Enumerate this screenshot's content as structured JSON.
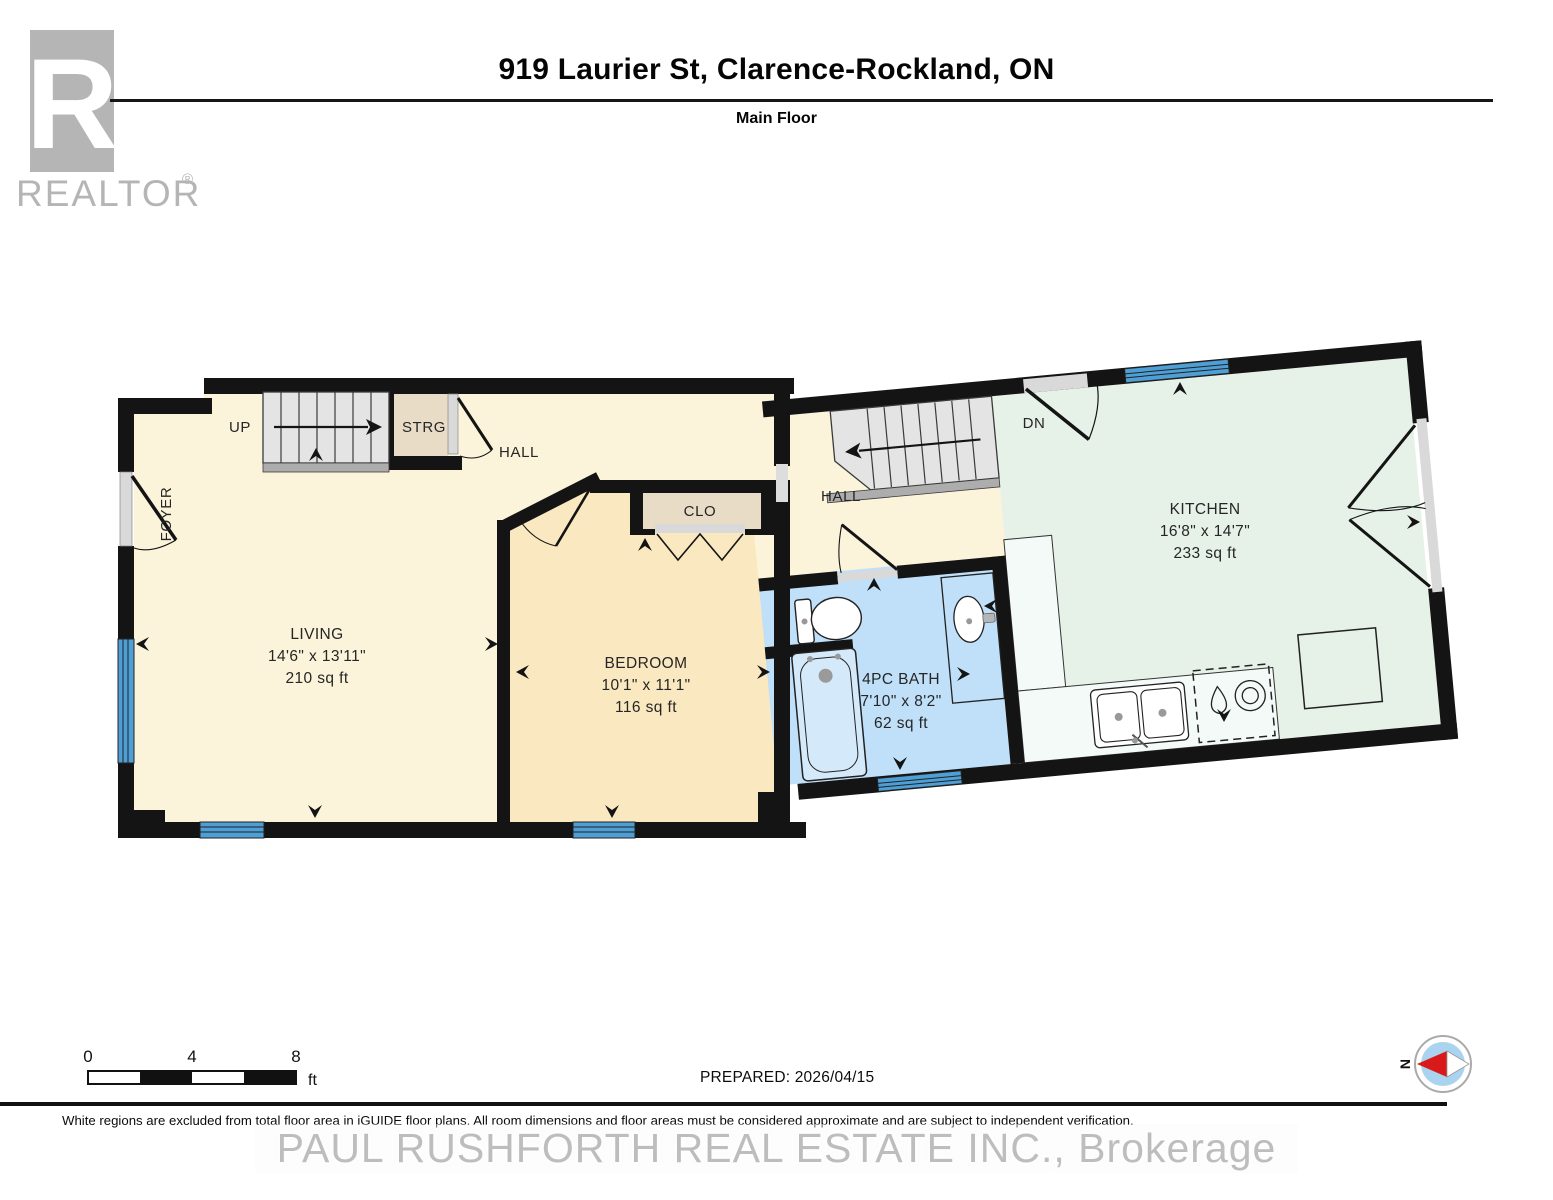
{
  "header": {
    "title": "919 Laurier St, Clarence-Rockland, ON",
    "subtitle": "Main Floor"
  },
  "branding": {
    "realtor_r": "R",
    "realtor_text": "REALTOR",
    "registered_mark": "®"
  },
  "rooms": {
    "living": {
      "name": "LIVING",
      "dims": "14'6\" x 13'11\"",
      "area": "210 sq ft"
    },
    "bedroom": {
      "name": "BEDROOM",
      "dims": "10'1\" x 11'1\"",
      "area": "116 sq ft"
    },
    "kitchen": {
      "name": "KITCHEN",
      "dims": "16'8\" x 14'7\"",
      "area": "233 sq ft"
    },
    "bath": {
      "name": "4PC BATH",
      "dims": "7'10\" x 8'2\"",
      "area": "62 sq ft"
    },
    "foyer": {
      "name": "FOYER"
    },
    "hall_left": {
      "name": "HALL"
    },
    "hall_right": {
      "name": "HALL"
    },
    "closet": {
      "name": "CLO"
    },
    "storage": {
      "name": "STRG"
    }
  },
  "stairs": {
    "up": "UP",
    "down": "DN"
  },
  "footer": {
    "prepared": "PREPARED: 2026/04/15",
    "disclaimer": "White regions are excluded from total floor area in iGUIDE floor plans. All room dimensions and floor areas must be considered approximate and are subject to independent verification.",
    "scale_ticks": [
      "0",
      "4",
      "8"
    ],
    "scale_unit": "ft",
    "compass_north": "N"
  },
  "watermark": {
    "brokerage": "PAUL RUSHFORTH REAL ESTATE INC.,  Brokerage"
  },
  "colors": {
    "wall": "#141414",
    "window_blue": "#4D9FD6",
    "room_cream": "#FBF3DA",
    "room_bedroom": "#FAE8C1",
    "room_kitchen": "#E6F1E8",
    "room_bath": "#BFE0F8",
    "tub_blue": "#D4EAFB",
    "closet_beige": "#E8DCC6",
    "stairs_gray": "#E4E4E4",
    "door_sill_gray": "#D9D9D9",
    "compass_blue": "#A9D3EE",
    "compass_red": "#D91A1A",
    "logo_gray": "#b5b5b5"
  }
}
